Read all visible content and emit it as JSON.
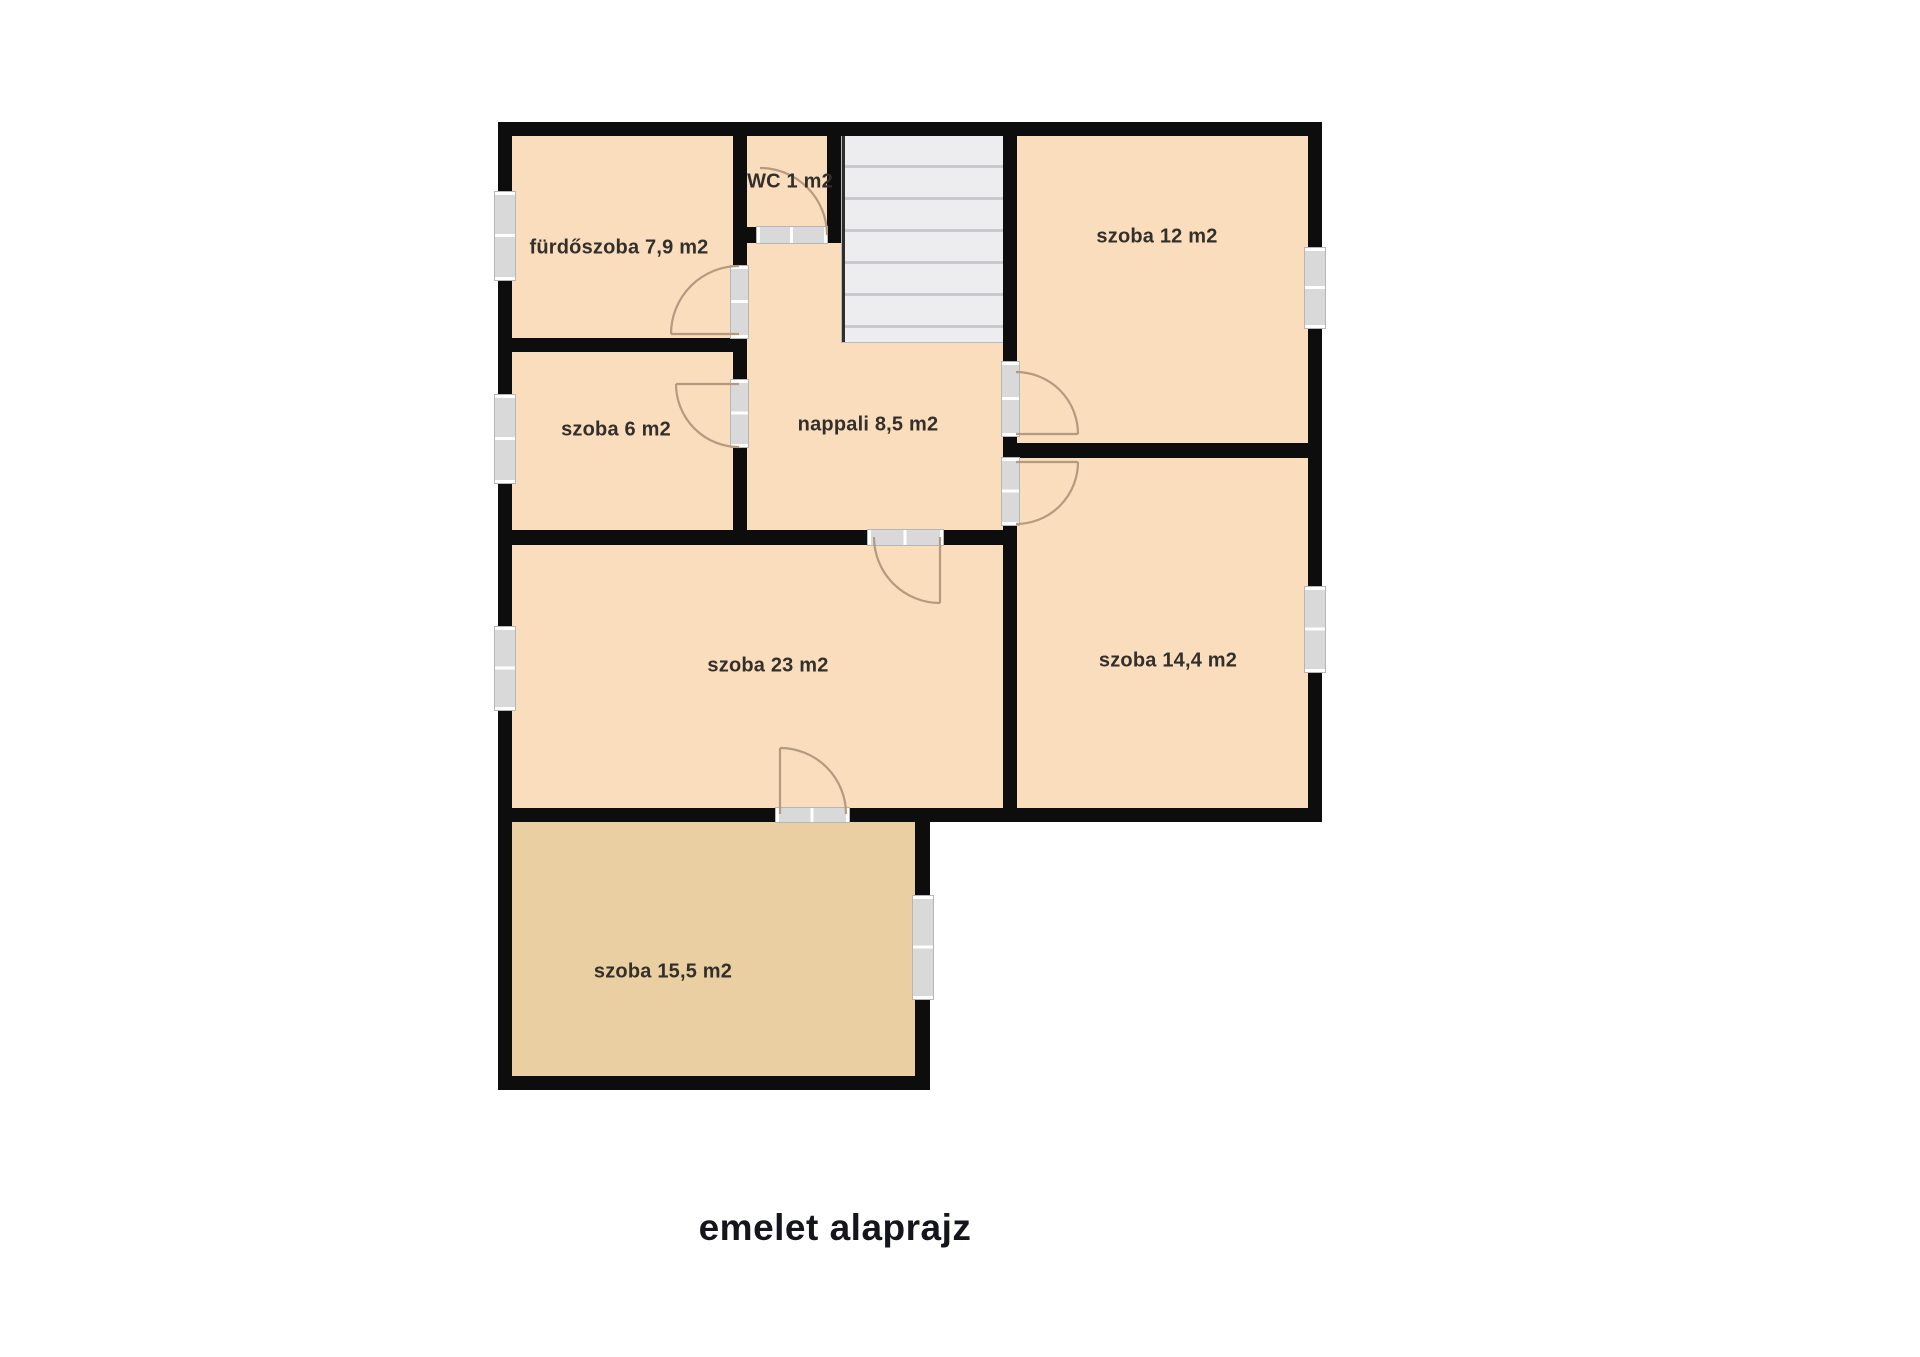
{
  "title": "emelet alaprajz",
  "rooms": [
    {
      "id": "furdoszoba",
      "label": "fürdőszoba 7,9 m2"
    },
    {
      "id": "wc",
      "label": "WC 1 m2"
    },
    {
      "id": "szoba-12",
      "label": "szoba 12 m2"
    },
    {
      "id": "szoba-6",
      "label": "szoba 6 m2"
    },
    {
      "id": "nappali",
      "label": "nappali 8,5 m2"
    },
    {
      "id": "szoba-23",
      "label": "szoba 23 m2"
    },
    {
      "id": "szoba-14-4",
      "label": "szoba 14,4 m2"
    },
    {
      "id": "szoba-15-5",
      "label": "szoba 15,5 m2"
    }
  ],
  "colors": {
    "wall": "#0d0d0d",
    "floor": "#f9ddbd",
    "floor_dark": "#e9cfa2",
    "window": "#d9d9d9",
    "stairs": "#ededf0",
    "stair_line": "#c9c9cd",
    "door_arc": "#b49b80",
    "label": "#332f2b",
    "title": "#15151c"
  }
}
